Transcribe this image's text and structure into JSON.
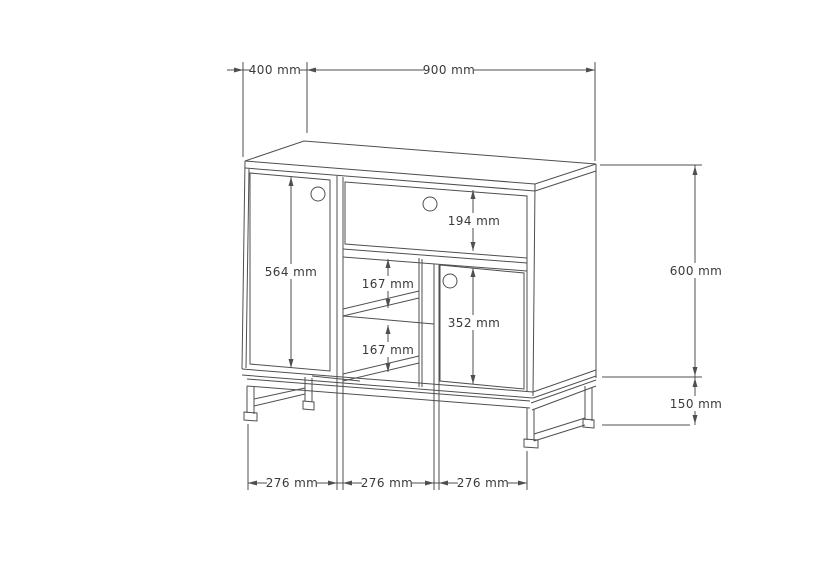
{
  "drawing": {
    "subject": "sideboard cabinet technical drawing with doors, drawer, shelves and metal leg frame",
    "unit": "mm",
    "line_color": "#4f4f4f",
    "text_color": "#3a3a3a",
    "background_color": "#ffffff",
    "dims": {
      "depth": {
        "label": "400 mm",
        "value": 400
      },
      "width": {
        "label": "900 mm",
        "value": 900
      },
      "body_height": {
        "label": "600 mm",
        "value": 600
      },
      "leg_height": {
        "label": "150 mm",
        "value": 150
      },
      "drawer_height": {
        "label": "194 mm",
        "value": 194
      },
      "left_door_height": {
        "label": "564 mm",
        "value": 564
      },
      "upper_shelf_gap": {
        "label": "167 mm",
        "value": 167
      },
      "lower_shelf_gap": {
        "label": "167 mm",
        "value": 167
      },
      "right_door_height": {
        "label": "352 mm",
        "value": 352
      },
      "left_section_width": {
        "label": "276 mm",
        "value": 276
      },
      "middle_section_width": {
        "label": "276 mm",
        "value": 276
      },
      "right_section_width": {
        "label": "276 mm",
        "value": 276
      }
    }
  }
}
